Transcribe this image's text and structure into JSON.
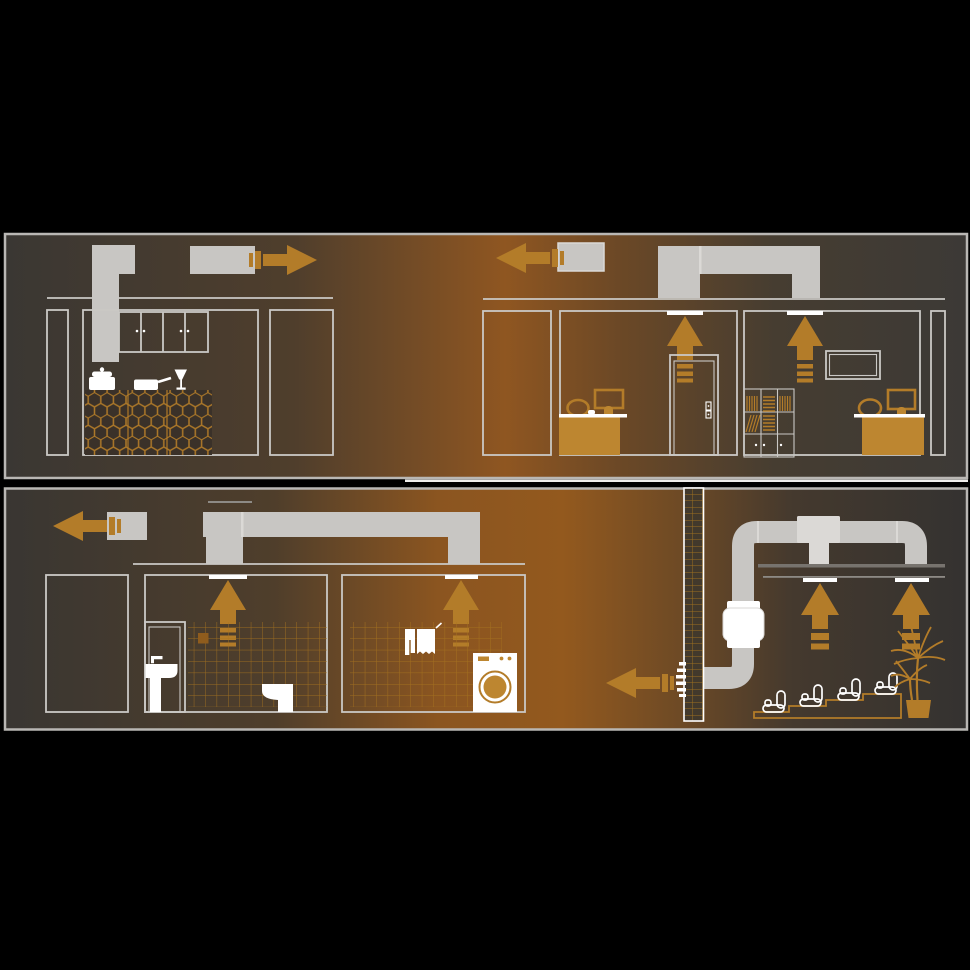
{
  "illustration": "apartment-ventilation-airflow-diagram",
  "colors": {
    "background": "#000000",
    "panel_border": "#b9b7b4",
    "divider_white": "#efeeec",
    "duct_gray": "#c8c6c3",
    "duct_light": "#dbd9d6",
    "outline_gray": "#cac8c5",
    "white": "#ffffff",
    "accent_orange": "#b37c29",
    "furniture_orange": "#bd8630",
    "tile_line_orange": "#a8751f",
    "tile_filled_orange": "#8f5c1d",
    "wall_fill_brown": "#42392c",
    "island_fill_brown": "#3a3129",
    "ceiling_dark": "#77736e",
    "ceiling_thin": "#8d8a85"
  },
  "gradients": {
    "grad-top-panel": [
      [
        "0%",
        "#3a3733"
      ],
      [
        "30%",
        "#4f3e2c"
      ],
      [
        "52%",
        "#8f5621"
      ],
      [
        "64%",
        "#6b4826"
      ],
      [
        "80%",
        "#463d31"
      ],
      [
        "100%",
        "#3c3936"
      ]
    ],
    "grad-bottom-panel": [
      [
        "0%",
        "#393632"
      ],
      [
        "28%",
        "#4f3e2b"
      ],
      [
        "45%",
        "#8b5520"
      ],
      [
        "58%",
        "#93591e"
      ],
      [
        "70%",
        "#6e4a25"
      ],
      [
        "82%",
        "#44392e"
      ],
      [
        "100%",
        "#343230"
      ]
    ]
  },
  "panels": [
    {
      "name": "upper-floor-section",
      "scenes": [
        {
          "name": "kitchen",
          "icons": [
            "kitchen-hood-duct-icon",
            "exhaust-duct-icon",
            "airflow-arrow-right-icon",
            "wall-cabinets-icon",
            "cooking-pot-icon",
            "frying-pan-icon",
            "wine-glass-icon",
            "hex-tile-island-icon"
          ],
          "airflow": "out-to-right"
        },
        {
          "name": "office-rooms",
          "icons": [
            "exhaust-duct-icon",
            "airflow-arrow-left-icon",
            "ceiling-duct-bridge-icon",
            "ceiling-vent-icon",
            "airflow-arrow-up-icon",
            "door-icon",
            "desk-icon",
            "monitor-icon",
            "office-chair-icon",
            "bookshelf-icon",
            "wall-tv-icon"
          ],
          "airflow": "up-through-ceiling-out-to-left"
        }
      ]
    },
    {
      "name": "lower-floor-section",
      "scenes": [
        {
          "name": "bathroom-and-laundry",
          "icons": [
            "exhaust-duct-icon",
            "airflow-arrow-left-icon",
            "ceiling-duct-bridge-icon",
            "ceiling-vent-icon",
            "airflow-arrow-up-icon",
            "bathroom-door-icon",
            "pedestal-sink-icon",
            "toilet-icon",
            "wall-tiles-icon",
            "hanging-towels-icon",
            "washing-machine-icon"
          ],
          "airflow": "up-through-ceiling-out-to-left"
        },
        {
          "name": "home-cinema",
          "icons": [
            "tiled-shaft-wall-icon",
            "duct-pipe-icon",
            "inline-duct-fan-icon",
            "tee-junction-icon",
            "suspended-ceiling-icon",
            "ceiling-vent-icon",
            "airflow-arrow-up-icon",
            "wall-connector-icon",
            "airflow-arrow-left-icon",
            "stepped-platform-icon",
            "cinema-seat-icon",
            "palm-plant-icon"
          ],
          "airflow": "up-through-ceiling-fan-out-to-left"
        }
      ]
    }
  ]
}
